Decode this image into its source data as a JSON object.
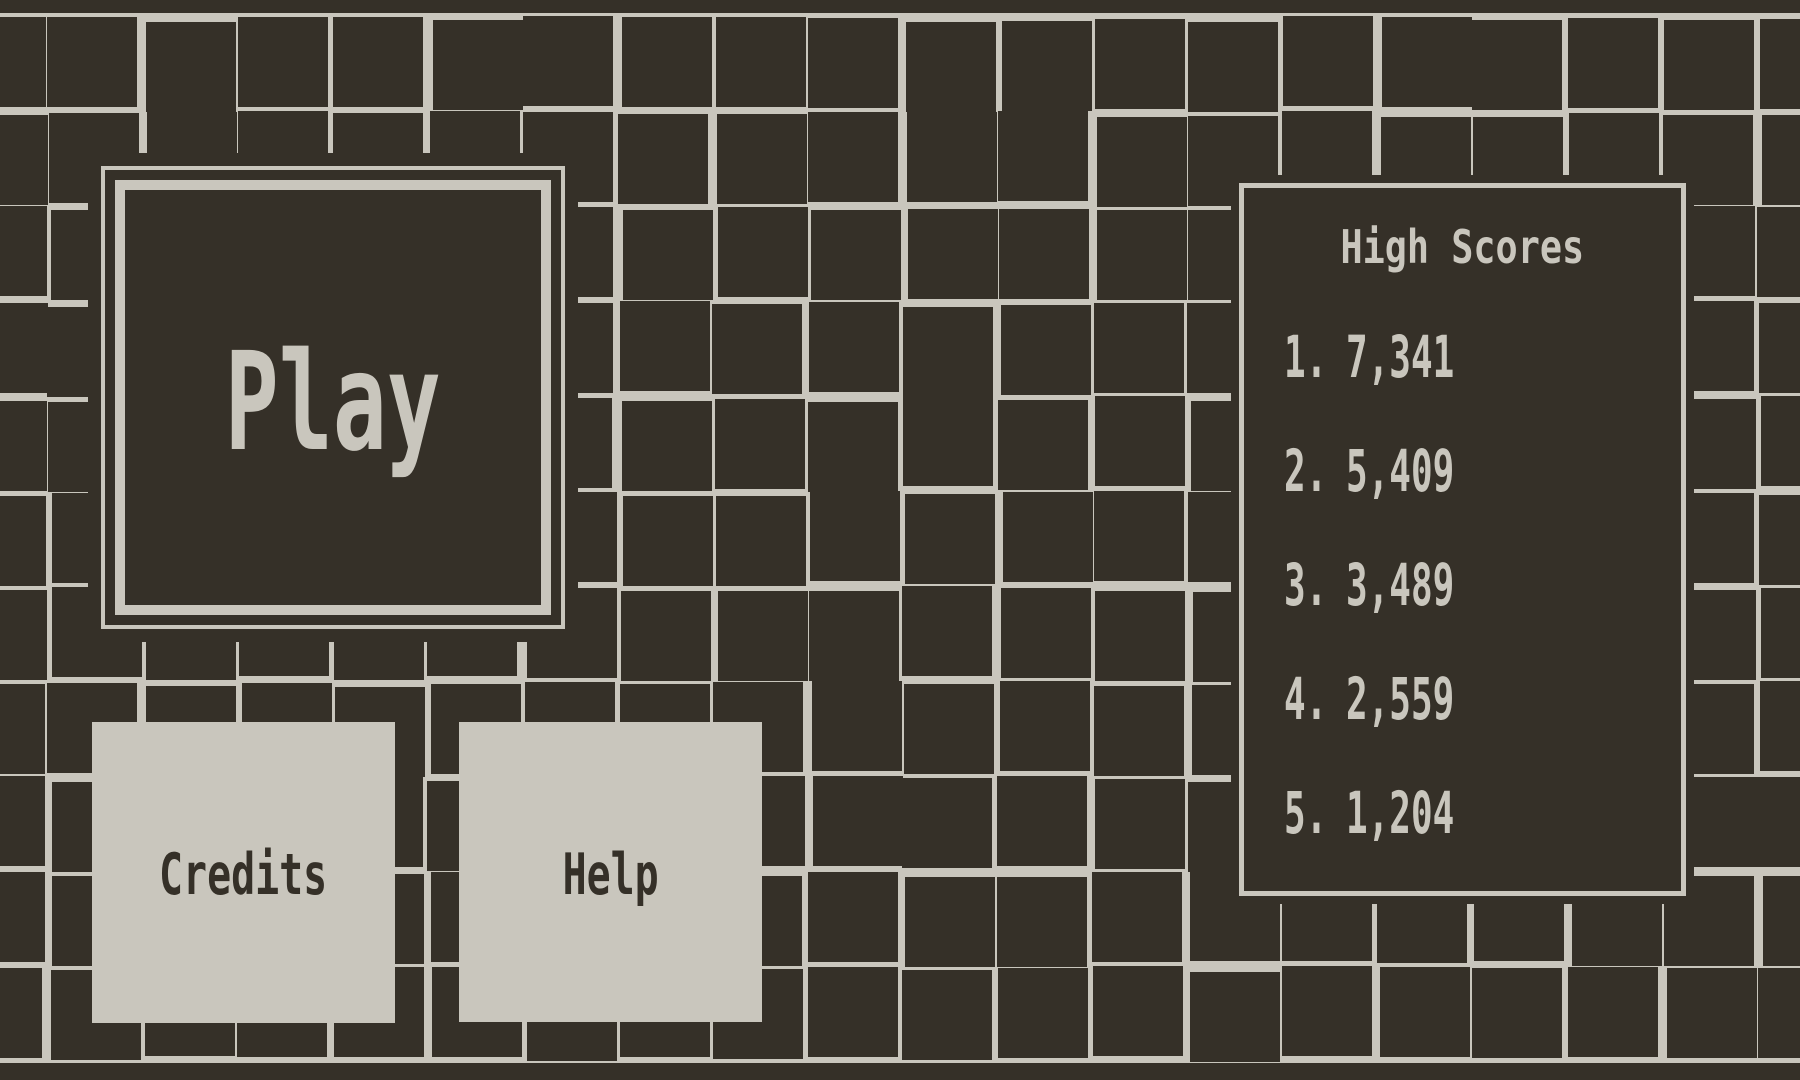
{
  "colors": {
    "background_dark": "#353028",
    "grid_line": "#c9c6bd",
    "panel_light": "#c9c6bd",
    "text_dark": "#353028",
    "text_light": "#c9c6bd"
  },
  "menu": {
    "play_label": "Play",
    "credits_label": "Credits",
    "help_label": "Help"
  },
  "high_scores": {
    "title": "High Scores",
    "entries": [
      {
        "rank_label": "1.",
        "score": "7,341"
      },
      {
        "rank_label": "2.",
        "score": "5,409"
      },
      {
        "rank_label": "3.",
        "score": "3,489"
      },
      {
        "rank_label": "4.",
        "score": "2,559"
      },
      {
        "rank_label": "5.",
        "score": "1,204"
      }
    ]
  }
}
